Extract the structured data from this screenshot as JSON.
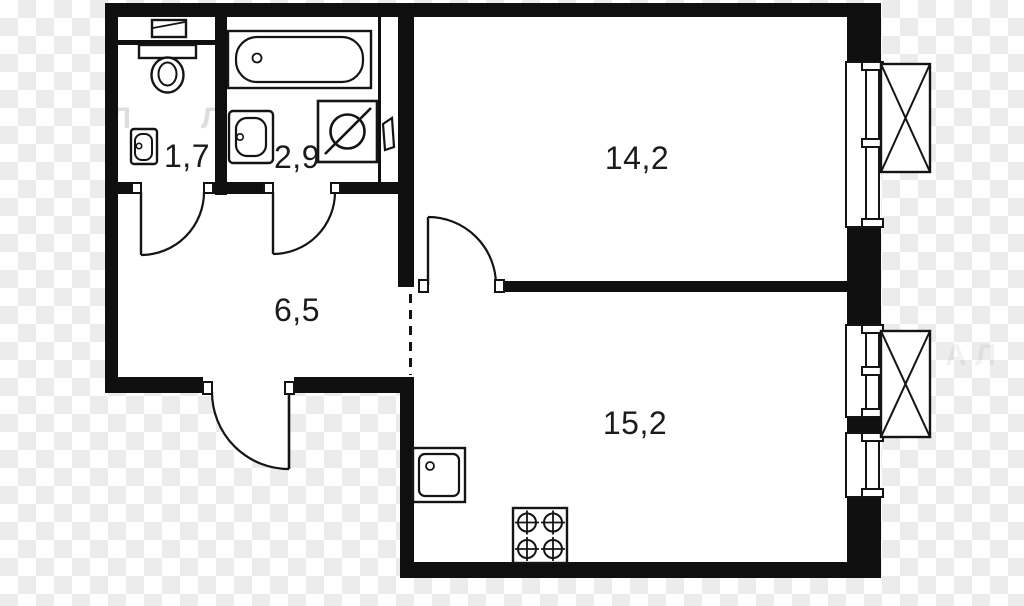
{
  "plan": {
    "rooms": [
      {
        "id": "wc",
        "area_label": "1,7"
      },
      {
        "id": "bathroom",
        "area_label": "2,9"
      },
      {
        "id": "hallway",
        "area_label": "6,5"
      },
      {
        "id": "living-room",
        "area_label": "14,2"
      },
      {
        "id": "kitchen-living",
        "area_label": "15,2"
      }
    ],
    "fixtures": [
      "toilet",
      "cistern-shelf",
      "wc-wall-sink",
      "bathtub",
      "bath-wall-sink",
      "washing-machine",
      "heated-towel-rail",
      "kitchen-sink",
      "cooktop-4-burner"
    ],
    "openings": {
      "doors": [
        "wc-door",
        "bathroom-door",
        "living-room-door",
        "entrance-door"
      ],
      "windows": [
        "living-room-window",
        "kitchen-window-upper",
        "kitchen-window-lower"
      ],
      "ac_baskets": [
        "ac-basket-living-room",
        "ac-basket-kitchen"
      ],
      "open_passage": "hallway-kitchen-dashed-opening"
    },
    "watermark_fragments": [
      "Л",
      "Л",
      "А Л"
    ],
    "colors": {
      "wall": "#0f0f0f",
      "line": "#141414",
      "floor": "#ffffff",
      "checker": "#ececec"
    }
  }
}
